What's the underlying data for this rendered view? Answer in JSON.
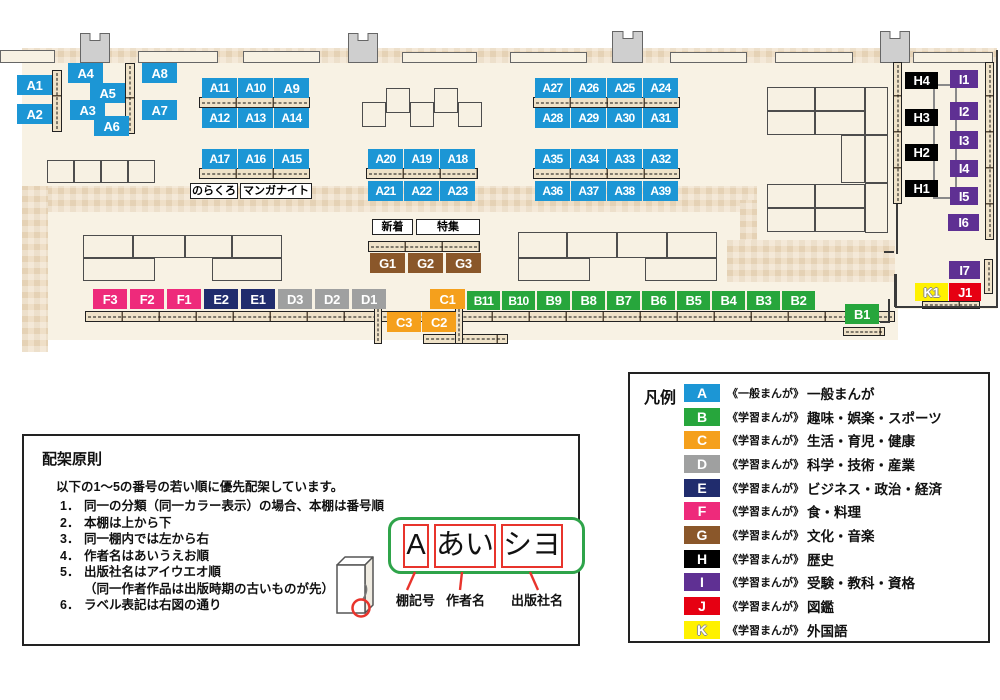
{
  "map": {
    "colors": {
      "A": "#1C96D5",
      "B": "#27A63C",
      "C": "#F5A01C",
      "D": "#9FA0A0",
      "E": "#202C6D",
      "F": "#EE2A7B",
      "G": "#8A572A",
      "H": "#000000",
      "I": "#5F3093",
      "J": "#E60012",
      "K": "#FFF100"
    },
    "shelf_labels": [
      {
        "id": "A1",
        "x": 17,
        "y": 75
      },
      {
        "id": "A2",
        "x": 17,
        "y": 104
      },
      {
        "id": "A4",
        "x": 68,
        "y": 63
      },
      {
        "id": "A5",
        "x": 90,
        "y": 83
      },
      {
        "id": "A3",
        "x": 70,
        "y": 100
      },
      {
        "id": "A6",
        "x": 94,
        "y": 116
      },
      {
        "id": "A8",
        "x": 142,
        "y": 63
      },
      {
        "id": "A7",
        "x": 142,
        "y": 100
      },
      {
        "id": "A11",
        "x": 202,
        "y": 78
      },
      {
        "id": "A10",
        "x": 238,
        "y": 78
      },
      {
        "id": "A9",
        "x": 274,
        "y": 78
      },
      {
        "id": "A12",
        "x": 202,
        "y": 108
      },
      {
        "id": "A13",
        "x": 238,
        "y": 108
      },
      {
        "id": "A14",
        "x": 274,
        "y": 108
      },
      {
        "id": "A17",
        "x": 202,
        "y": 149
      },
      {
        "id": "A16",
        "x": 238,
        "y": 149
      },
      {
        "id": "A15",
        "x": 274,
        "y": 149
      },
      {
        "id": "A20",
        "x": 368,
        "y": 149
      },
      {
        "id": "A19",
        "x": 404,
        "y": 149
      },
      {
        "id": "A18",
        "x": 440,
        "y": 149
      },
      {
        "id": "A21",
        "x": 368,
        "y": 181
      },
      {
        "id": "A22",
        "x": 404,
        "y": 181
      },
      {
        "id": "A23",
        "x": 440,
        "y": 181
      },
      {
        "id": "A27",
        "x": 535,
        "y": 78
      },
      {
        "id": "A26",
        "x": 571,
        "y": 78
      },
      {
        "id": "A25",
        "x": 607,
        "y": 78
      },
      {
        "id": "A24",
        "x": 643,
        "y": 78
      },
      {
        "id": "A28",
        "x": 535,
        "y": 108
      },
      {
        "id": "A29",
        "x": 571,
        "y": 108
      },
      {
        "id": "A30",
        "x": 607,
        "y": 108
      },
      {
        "id": "A31",
        "x": 643,
        "y": 108
      },
      {
        "id": "A35",
        "x": 535,
        "y": 149
      },
      {
        "id": "A34",
        "x": 571,
        "y": 149
      },
      {
        "id": "A33",
        "x": 607,
        "y": 149
      },
      {
        "id": "A32",
        "x": 643,
        "y": 149
      },
      {
        "id": "A36",
        "x": 535,
        "y": 181
      },
      {
        "id": "A37",
        "x": 571,
        "y": 181
      },
      {
        "id": "A38",
        "x": 607,
        "y": 181
      },
      {
        "id": "A39",
        "x": 643,
        "y": 181
      },
      {
        "id": "G1",
        "x": 370,
        "y": 253
      },
      {
        "id": "G2",
        "x": 408,
        "y": 253
      },
      {
        "id": "G3",
        "x": 446,
        "y": 253
      },
      {
        "id": "F3",
        "x": 93,
        "y": 289,
        "w": 34
      },
      {
        "id": "F2",
        "x": 130,
        "y": 289,
        "w": 34
      },
      {
        "id": "F1",
        "x": 167,
        "y": 289,
        "w": 34
      },
      {
        "id": "E2",
        "x": 204,
        "y": 289,
        "w": 34
      },
      {
        "id": "E1",
        "x": 241,
        "y": 289,
        "w": 34
      },
      {
        "id": "D3",
        "x": 278,
        "y": 289,
        "w": 34
      },
      {
        "id": "D2",
        "x": 315,
        "y": 289,
        "w": 34
      },
      {
        "id": "D1",
        "x": 352,
        "y": 289,
        "w": 34
      },
      {
        "id": "C1",
        "x": 430,
        "y": 289
      },
      {
        "id": "C3",
        "x": 387,
        "y": 312,
        "w": 34
      },
      {
        "id": "C2",
        "x": 422,
        "y": 312,
        "w": 34
      },
      {
        "id": "B11",
        "x": 467,
        "y": 291,
        "w": 33,
        "h": 19
      },
      {
        "id": "B10",
        "x": 502,
        "y": 291,
        "w": 33,
        "h": 19
      },
      {
        "id": "B9",
        "x": 537,
        "y": 291,
        "w": 33,
        "h": 19
      },
      {
        "id": "B8",
        "x": 572,
        "y": 291,
        "w": 33,
        "h": 19
      },
      {
        "id": "B7",
        "x": 607,
        "y": 291,
        "w": 33,
        "h": 19
      },
      {
        "id": "B6",
        "x": 642,
        "y": 291,
        "w": 33,
        "h": 19
      },
      {
        "id": "B5",
        "x": 677,
        "y": 291,
        "w": 33,
        "h": 19
      },
      {
        "id": "B4",
        "x": 712,
        "y": 291,
        "w": 33,
        "h": 19
      },
      {
        "id": "B3",
        "x": 747,
        "y": 291,
        "w": 33,
        "h": 19
      },
      {
        "id": "B2",
        "x": 782,
        "y": 291,
        "w": 33,
        "h": 19
      },
      {
        "id": "B1",
        "x": 845,
        "y": 304,
        "w": 34
      },
      {
        "id": "H4",
        "x": 905,
        "y": 72,
        "w": 33,
        "h": 17
      },
      {
        "id": "H3",
        "x": 905,
        "y": 109,
        "w": 33,
        "h": 17
      },
      {
        "id": "H2",
        "x": 905,
        "y": 144,
        "w": 33,
        "h": 17
      },
      {
        "id": "H1",
        "x": 905,
        "y": 180,
        "w": 33,
        "h": 17
      },
      {
        "id": "I1",
        "x": 950,
        "y": 70,
        "w": 28,
        "h": 18
      },
      {
        "id": "I2",
        "x": 950,
        "y": 102,
        "w": 28,
        "h": 18
      },
      {
        "id": "I3",
        "x": 950,
        "y": 131,
        "w": 28,
        "h": 18
      },
      {
        "id": "I4",
        "x": 950,
        "y": 160,
        "w": 28,
        "h": 17
      },
      {
        "id": "I5",
        "x": 950,
        "y": 187,
        "w": 28,
        "h": 18
      },
      {
        "id": "I6",
        "x": 948,
        "y": 214,
        "w": 31,
        "h": 17
      },
      {
        "id": "I7",
        "x": 949,
        "y": 261,
        "w": 31,
        "h": 18
      },
      {
        "id": "K1",
        "x": 915,
        "y": 283,
        "w": 33,
        "h": 18
      },
      {
        "id": "J1",
        "x": 949,
        "y": 283,
        "w": 32,
        "h": 18
      }
    ],
    "text_boxes": [
      {
        "id": "norakuro",
        "text": "のらくろ",
        "x": 190,
        "y": 183,
        "w": 48,
        "h": 16
      },
      {
        "id": "manga-night",
        "text": "マンガナイト",
        "x": 240,
        "y": 183,
        "w": 72,
        "h": 16
      },
      {
        "id": "new-arrivals",
        "text": "新着",
        "x": 372,
        "y": 219,
        "w": 41,
        "h": 16
      },
      {
        "id": "special-feature",
        "text": "特集",
        "x": 416,
        "y": 219,
        "w": 64,
        "h": 16
      }
    ]
  },
  "legend": {
    "title": "凡例",
    "items": [
      {
        "letter": "A",
        "prefix": "《一般まんが》",
        "category": "一般まんが"
      },
      {
        "letter": "B",
        "prefix": "《学習まんが》",
        "category": "趣味・娯楽・スポーツ"
      },
      {
        "letter": "C",
        "prefix": "《学習まんが》",
        "category": "生活・育児・健康"
      },
      {
        "letter": "D",
        "prefix": "《学習まんが》",
        "category": "科学・技術・産業"
      },
      {
        "letter": "E",
        "prefix": "《学習まんが》",
        "category": "ビジネス・政治・経済"
      },
      {
        "letter": "F",
        "prefix": "《学習まんが》",
        "category": "食・料理"
      },
      {
        "letter": "G",
        "prefix": "《学習まんが》",
        "category": "文化・音楽"
      },
      {
        "letter": "H",
        "prefix": "《学習まんが》",
        "category": "歴史"
      },
      {
        "letter": "I",
        "prefix": "《学習まんが》",
        "category": "受験・教科・資格"
      },
      {
        "letter": "J",
        "prefix": "《学習まんが》",
        "category": "図鑑"
      },
      {
        "letter": "K",
        "prefix": "《学習まんが》",
        "category": "外国語"
      }
    ]
  },
  "principles": {
    "title": "配架原則",
    "intro": "以下の1～5の番号の若い順に優先配架しています。",
    "items": [
      {
        "num": "1．",
        "text": "同一の分類（同一カラー表示）の場合、本棚は番号順"
      },
      {
        "num": "2．",
        "text": "本棚は上から下"
      },
      {
        "num": "3．",
        "text": "同一棚内では左から右"
      },
      {
        "num": "4．",
        "text": "作者名はあいうえお順"
      },
      {
        "num": "5．",
        "text": "出版社名はアイウエオ順"
      },
      {
        "num": "",
        "text": "（同一作者作品は出版時期の古いものが先）"
      },
      {
        "num": "6．",
        "text": "ラベル表記は右図の通り"
      }
    ]
  },
  "label_diagram": {
    "shelf_code": "A",
    "author": "あい",
    "publisher": "シヨ",
    "captions": {
      "shelf_code": "棚記号",
      "author": "作者名",
      "publisher": "出版社名"
    }
  }
}
